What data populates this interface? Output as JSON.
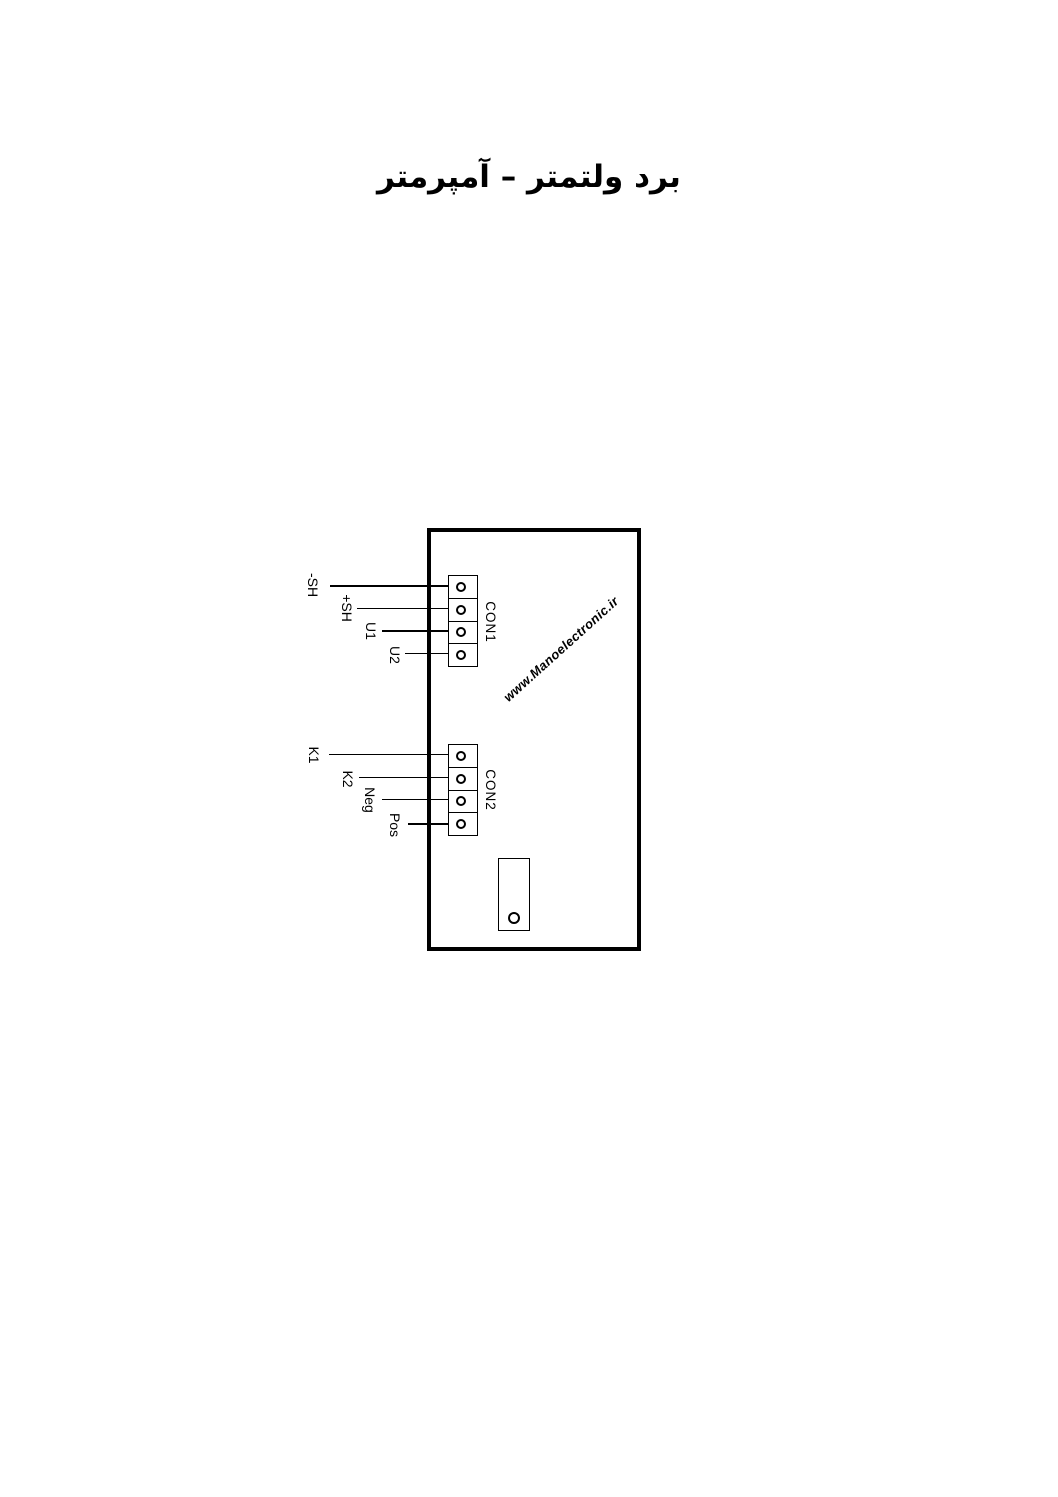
{
  "page": {
    "title": "برد ولتمتر – آمپرمتر",
    "watermark": "www.Manoelectronic.ir",
    "colors": {
      "ink": "#000000",
      "paper": "#ffffff"
    }
  },
  "diagram": {
    "con1": {
      "name": "CON1",
      "pins": [
        "-SH",
        "+SH",
        "U1",
        "U2"
      ]
    },
    "con2": {
      "name": "CON2",
      "pins": [
        "K1",
        "K2",
        "Neg",
        "Pos"
      ]
    }
  }
}
